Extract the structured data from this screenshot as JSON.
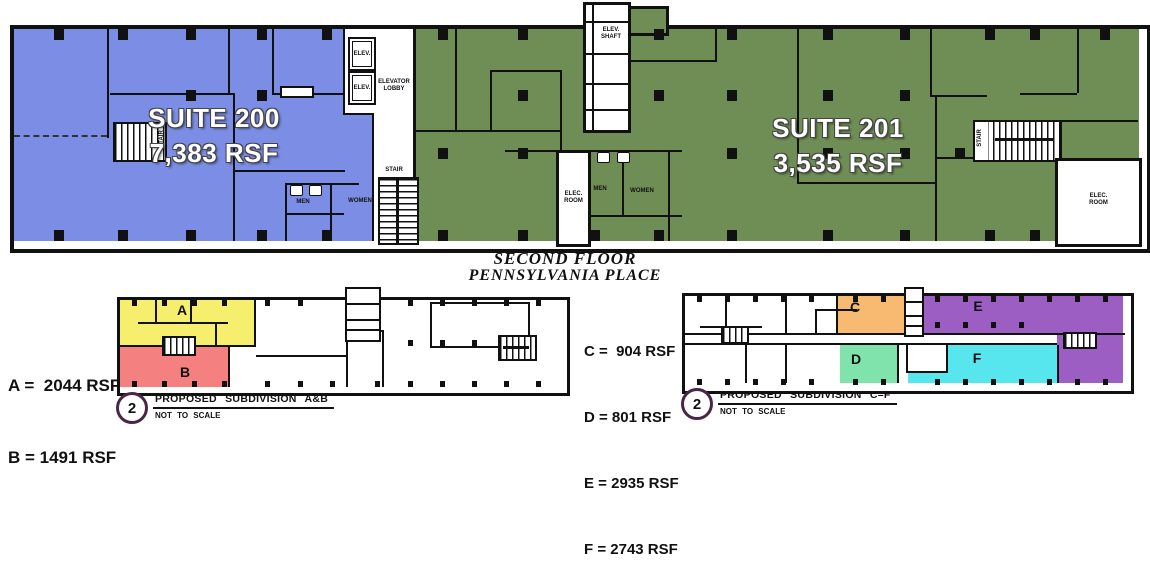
{
  "document": {
    "title_line1": "SECOND FLOOR",
    "title_line2": "PENNSYLVANIA PLACE"
  },
  "main_plan": {
    "suite200": {
      "name": "SUITE 200",
      "area": "7,383 RSF"
    },
    "suite201": {
      "name": "SUITE 201",
      "area": "3,535 RSF"
    },
    "labels": {
      "elev": "ELEV.",
      "elevator_line1": "ELEVATOR",
      "elevator_line2": "LOBBY",
      "stair": "STAIR",
      "shaft_line1": "ELEV.",
      "shaft_line2": "SHAFT",
      "elec_line1": "ELEC.",
      "elec_line2": "ROOM",
      "men": "MEN",
      "women": "WOMEN"
    }
  },
  "subdivision_ab": {
    "legend_a": "A =  2044 RSF",
    "legend_b": "B = 1491 RSF",
    "label_a": "A",
    "label_b": "B",
    "marker": "2",
    "caption": "PROPOSED SUBDIVISION A&B",
    "note": "NOT TO SCALE"
  },
  "subdivision_cf": {
    "legend_c": "C =  904 RSF",
    "legend_d": "D = 801 RSF",
    "legend_e": "E = 2935 RSF",
    "legend_f": "F = 2743 RSF",
    "label_c": "C",
    "label_d": "D",
    "label_e": "E",
    "label_f": "F",
    "marker": "2",
    "caption": "PROPOSED SUBDIVISION C–F",
    "note": "NOT TO SCALE"
  },
  "colors": {
    "suite200_fill": "#7b8de4",
    "suite201_fill": "#6f8e55",
    "sub_a_fill": "#f6ef6e",
    "sub_b_fill": "#f58080",
    "sub_c_fill": "#f7ba70",
    "sub_d_fill": "#80e3ab",
    "sub_e_fill": "#9d5ec4",
    "sub_f_fill": "#58e6ee",
    "wall": "#111111",
    "marker_ring": "#4a2547"
  }
}
